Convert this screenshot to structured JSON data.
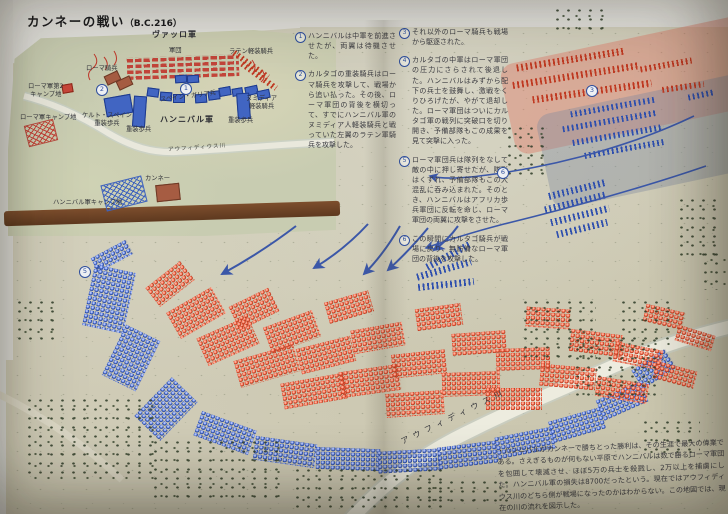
{
  "page": {
    "title": "カンネーの戦い",
    "title_suffix": "（B.C.216）"
  },
  "inset_map": {
    "labels": {
      "varro_army": "ヴァッロ軍",
      "legion": "軍団",
      "latin_cavalry": "ラテン軽装騎兵",
      "roman_cavalry": "ローマ騎兵",
      "roman_camp2": "ローマ軍第2\nキャンプ地",
      "roman_camp": "ローマ軍キャンプ地",
      "celt_spain_heavy": "ケルト・スペイン\n重装歩兵",
      "heavy_infantry_left": "重装歩兵",
      "spain_gaul": "スペイン・ガリア兵",
      "numidia_light_cavalry": "ヌミディア\n軽装騎兵",
      "heavy_infantry_right": "重装歩兵",
      "hannibal_army": "ハンニバル軍",
      "cannae": "カンネー",
      "hannibal_camp": "ハンニバル軍キャンプ地",
      "river": "アウフィディウス川"
    },
    "markers": [
      {
        "num": "2",
        "x": 96,
        "y": 84
      },
      {
        "num": "1",
        "x": 180,
        "y": 83
      }
    ],
    "units": [
      {
        "t": "bricks-red",
        "x": 127,
        "y": 56,
        "w": 112,
        "h": 22,
        "r": -2
      },
      {
        "t": "row-red",
        "x": 230,
        "y": 62,
        "w": 42,
        "h": 6,
        "r": 36
      },
      {
        "t": "row-red",
        "x": 238,
        "y": 73,
        "w": 42,
        "h": 6,
        "r": 36
      },
      {
        "t": "block-brown",
        "x": 105,
        "y": 73,
        "w": 13,
        "h": 8,
        "r": -25
      },
      {
        "t": "block-brown",
        "x": 117,
        "y": 78,
        "w": 13,
        "h": 8,
        "r": -25
      },
      {
        "t": "block-blue",
        "x": 175,
        "y": 75,
        "w": 10,
        "h": 6,
        "r": -4
      },
      {
        "t": "block-blue",
        "x": 187,
        "y": 75,
        "w": 10,
        "h": 6,
        "r": -4
      },
      {
        "t": "block-blue",
        "x": 147,
        "y": 88,
        "w": 10,
        "h": 7,
        "r": 8
      },
      {
        "t": "block-blue",
        "x": 160,
        "y": 92,
        "w": 10,
        "h": 7,
        "r": 4
      },
      {
        "t": "block-blue",
        "x": 173,
        "y": 94,
        "w": 10,
        "h": 7,
        "r": 0
      },
      {
        "t": "block-blue",
        "x": 195,
        "y": 94,
        "w": 10,
        "h": 7,
        "r": -4
      },
      {
        "t": "block-blue",
        "x": 208,
        "y": 91,
        "w": 10,
        "h": 7,
        "r": -8
      },
      {
        "t": "block-blue",
        "x": 219,
        "y": 87,
        "w": 10,
        "h": 7,
        "r": -10
      },
      {
        "t": "block-blue",
        "x": 232,
        "y": 88,
        "w": 9,
        "h": 6,
        "r": -10
      },
      {
        "t": "block-blue",
        "x": 245,
        "y": 86,
        "w": 11,
        "h": 7,
        "r": -12
      },
      {
        "t": "block-blue",
        "x": 257,
        "y": 90,
        "w": 11,
        "h": 7,
        "r": -12
      },
      {
        "t": "block-blue",
        "x": 105,
        "y": 96,
        "w": 25,
        "h": 17,
        "r": -10
      },
      {
        "t": "block-blue",
        "x": 133,
        "y": 96,
        "w": 11,
        "h": 29,
        "r": 4
      },
      {
        "t": "block-blue",
        "x": 237,
        "y": 93,
        "w": 11,
        "h": 24,
        "r": -4
      },
      {
        "t": "hatch-red",
        "x": 26,
        "y": 122,
        "w": 28,
        "h": 20,
        "r": -14
      },
      {
        "t": "block-red",
        "x": 62,
        "y": 84,
        "w": 9,
        "h": 7,
        "r": -10
      },
      {
        "t": "hatch-blue",
        "x": 103,
        "y": 180,
        "w": 40,
        "h": 25,
        "r": -14
      },
      {
        "t": "block-brown",
        "x": 156,
        "y": 184,
        "w": 22,
        "h": 15,
        "r": -6
      }
    ]
  },
  "annotations": {
    "column1": [
      {
        "num": "1",
        "text": "ハンニバルは中軍を前進させたが、両翼は待機させた。"
      },
      {
        "num": "2",
        "text": "カルタゴの重装騎兵はローマ騎兵を攻撃して、戦場から追い払った。その後、ローマ軍団の背後を横切って、すでにハンニバル軍のヌミディア人軽装騎兵と戦っていた左翼のラテン軍騎兵を攻撃した。"
      }
    ],
    "column2": [
      {
        "num": "3",
        "text": "それ以外のローマ騎兵も戦場から駆逐された。"
      },
      {
        "num": "4",
        "text": "カルタゴの中軍はローマ軍団の圧力にさらされて後退した。ハンニバルはみずから配下の兵士を鼓舞し、激戦をくりひろげたが、やがて退却した。ローマ軍団はついにカルタゴ軍の戦列に突破口を切り開き、予備部隊もこの成果を見て突撃に入った。"
      },
      {
        "num": "5",
        "text": "ローマ軍団兵は隊列をなして敵の中に押し寄せたが、隊形はくずれ、予備部隊もこの大混乱に呑み込まれた。そのとき、ハンニバルはアフリカ歩兵軍団に反転を命じ、ローマ軍団の両翼に攻撃をさせた。"
      },
      {
        "num": "6",
        "text": "この瞬間にカルタゴ騎兵が戦場に戻り、無防備なローマ軍団の背後を攻撃した。"
      }
    ]
  },
  "main_map": {
    "river_label": "アウフィディウス川",
    "caption": "・ハンニバルがカンネーで勝ちとった勝利は、その生涯で最大の偉業である。さえぎるものが何もない平原でハンニバルは数で勝るローマ軍団を包囲して壊滅させ、ほぼ5万の兵士を殺戮し、2万以上を捕虜にした。ハンニバル軍の損失は8700だったという。現在ではアウフィディウス川のどちら側が戦場になったのかはわからない。この地図では、現在の川の流れを図示した。",
    "markers": [
      {
        "num": "3",
        "x": 586,
        "y": 85
      },
      {
        "num": "5",
        "x": 79,
        "y": 266
      },
      {
        "num": "6",
        "x": 497,
        "y": 167
      }
    ],
    "units": [
      {
        "t": "zone-pink",
        "x": 505,
        "y": 38,
        "w": 262,
        "h": 92,
        "r": -12
      },
      {
        "t": "zone-gray",
        "x": 542,
        "y": 92,
        "w": 225,
        "h": 96,
        "r": -12
      },
      {
        "t": "row-red",
        "x": 516,
        "y": 56,
        "w": 110,
        "h": 7,
        "r": -9
      },
      {
        "t": "row-red",
        "x": 512,
        "y": 72,
        "w": 128,
        "h": 7,
        "r": -9
      },
      {
        "t": "row-red",
        "x": 532,
        "y": 88,
        "w": 120,
        "h": 7,
        "r": -8
      },
      {
        "t": "row-red",
        "x": 640,
        "y": 62,
        "w": 52,
        "h": 6,
        "r": -10
      },
      {
        "t": "row-red",
        "x": 662,
        "y": 84,
        "w": 42,
        "h": 6,
        "r": -8
      },
      {
        "t": "row-blue",
        "x": 570,
        "y": 104,
        "w": 86,
        "h": 6,
        "r": -10
      },
      {
        "t": "row-blue",
        "x": 562,
        "y": 118,
        "w": 96,
        "h": 6,
        "r": -10
      },
      {
        "t": "row-blue",
        "x": 572,
        "y": 132,
        "w": 92,
        "h": 6,
        "r": -10
      },
      {
        "t": "row-blue",
        "x": 584,
        "y": 146,
        "w": 80,
        "h": 6,
        "r": -10
      },
      {
        "t": "row-blue",
        "x": 688,
        "y": 92,
        "w": 26,
        "h": 6,
        "r": -12
      },
      {
        "t": "row-blue",
        "x": 548,
        "y": 186,
        "w": 58,
        "h": 7,
        "r": -14
      },
      {
        "t": "row-blue",
        "x": 544,
        "y": 199,
        "w": 62,
        "h": 7,
        "r": -14
      },
      {
        "t": "row-blue",
        "x": 550,
        "y": 212,
        "w": 60,
        "h": 7,
        "r": -14
      },
      {
        "t": "row-blue",
        "x": 556,
        "y": 225,
        "w": 52,
        "h": 7,
        "r": -14
      },
      {
        "t": "row-blue",
        "x": 424,
        "y": 252,
        "w": 50,
        "h": 7,
        "r": -28
      },
      {
        "t": "row-blue",
        "x": 416,
        "y": 266,
        "w": 56,
        "h": 7,
        "r": -16
      },
      {
        "t": "row-blue",
        "x": 418,
        "y": 281,
        "w": 56,
        "h": 7,
        "r": -6
      },
      {
        "t": "beads-blue",
        "x": 92,
        "y": 248,
        "w": 40,
        "h": 16,
        "r": -28
      },
      {
        "t": "beads-blue",
        "x": 88,
        "y": 268,
        "w": 42,
        "h": 62,
        "r": 12
      },
      {
        "t": "beads-blue",
        "x": 112,
        "y": 330,
        "w": 38,
        "h": 56,
        "r": 26
      },
      {
        "t": "beads-blue",
        "x": 148,
        "y": 382,
        "w": 36,
        "h": 54,
        "r": 44
      },
      {
        "t": "beads-blue",
        "x": 196,
        "y": 420,
        "w": 58,
        "h": 26,
        "r": 20
      },
      {
        "t": "beads-blue",
        "x": 254,
        "y": 440,
        "w": 62,
        "h": 24,
        "r": 8
      },
      {
        "t": "beads-blue",
        "x": 316,
        "y": 448,
        "w": 64,
        "h": 22,
        "r": 2
      },
      {
        "t": "beads-blue",
        "x": 378,
        "y": 450,
        "w": 62,
        "h": 22,
        "r": -3
      },
      {
        "t": "beads-blue",
        "x": 438,
        "y": 444,
        "w": 60,
        "h": 22,
        "r": -7
      },
      {
        "t": "beads-blue",
        "x": 496,
        "y": 432,
        "w": 58,
        "h": 22,
        "r": -11
      },
      {
        "t": "beads-blue",
        "x": 550,
        "y": 414,
        "w": 54,
        "h": 22,
        "r": -16
      },
      {
        "t": "beads-blue",
        "x": 598,
        "y": 390,
        "w": 48,
        "h": 22,
        "r": -24
      },
      {
        "t": "beads-blue",
        "x": 634,
        "y": 358,
        "w": 40,
        "h": 22,
        "r": -33
      },
      {
        "t": "beads-red",
        "x": 148,
        "y": 272,
        "w": 44,
        "h": 24,
        "r": -38
      },
      {
        "t": "beads-red",
        "x": 170,
        "y": 298,
        "w": 52,
        "h": 30,
        "r": -30
      },
      {
        "t": "beads-red",
        "x": 200,
        "y": 326,
        "w": 56,
        "h": 30,
        "r": -24
      },
      {
        "t": "beads-red",
        "x": 232,
        "y": 296,
        "w": 44,
        "h": 26,
        "r": -26
      },
      {
        "t": "beads-red",
        "x": 236,
        "y": 352,
        "w": 62,
        "h": 28,
        "r": -16
      },
      {
        "t": "beads-red",
        "x": 266,
        "y": 318,
        "w": 52,
        "h": 28,
        "r": -20
      },
      {
        "t": "beads-red",
        "x": 282,
        "y": 378,
        "w": 64,
        "h": 26,
        "r": -10
      },
      {
        "t": "beads-red",
        "x": 298,
        "y": 342,
        "w": 56,
        "h": 26,
        "r": -14
      },
      {
        "t": "beads-red",
        "x": 326,
        "y": 296,
        "w": 46,
        "h": 22,
        "r": -16
      },
      {
        "t": "beads-red",
        "x": 340,
        "y": 368,
        "w": 60,
        "h": 26,
        "r": -8
      },
      {
        "t": "beads-red",
        "x": 352,
        "y": 326,
        "w": 52,
        "h": 24,
        "r": -10
      },
      {
        "t": "beads-red",
        "x": 386,
        "y": 392,
        "w": 58,
        "h": 24,
        "r": -4
      },
      {
        "t": "beads-red",
        "x": 392,
        "y": 352,
        "w": 54,
        "h": 24,
        "r": -6
      },
      {
        "t": "beads-red",
        "x": 416,
        "y": 306,
        "w": 46,
        "h": 22,
        "r": -8
      },
      {
        "t": "beads-red",
        "x": 442,
        "y": 372,
        "w": 58,
        "h": 24,
        "r": -2
      },
      {
        "t": "beads-red",
        "x": 452,
        "y": 332,
        "w": 54,
        "h": 22,
        "r": -4
      },
      {
        "t": "beads-red",
        "x": 486,
        "y": 388,
        "w": 56,
        "h": 22,
        "r": 0
      },
      {
        "t": "beads-red",
        "x": 496,
        "y": 348,
        "w": 54,
        "h": 22,
        "r": -2
      },
      {
        "t": "beads-red",
        "x": 526,
        "y": 308,
        "w": 44,
        "h": 20,
        "r": 4
      },
      {
        "t": "beads-red",
        "x": 540,
        "y": 366,
        "w": 56,
        "h": 22,
        "r": 5
      },
      {
        "t": "beads-red",
        "x": 570,
        "y": 332,
        "w": 52,
        "h": 22,
        "r": 7
      },
      {
        "t": "beads-red",
        "x": 596,
        "y": 380,
        "w": 52,
        "h": 20,
        "r": 9
      },
      {
        "t": "beads-red",
        "x": 614,
        "y": 346,
        "w": 48,
        "h": 20,
        "r": 11
      },
      {
        "t": "beads-red",
        "x": 644,
        "y": 308,
        "w": 40,
        "h": 18,
        "r": 13
      },
      {
        "t": "beads-red",
        "x": 654,
        "y": 366,
        "w": 42,
        "h": 18,
        "r": 15
      },
      {
        "t": "beads-red",
        "x": 676,
        "y": 330,
        "w": 38,
        "h": 16,
        "r": 17
      }
    ],
    "tree_clusters": [
      {
        "x": 504,
        "y": 124,
        "w": 40,
        "h": 54
      },
      {
        "x": 552,
        "y": 6,
        "w": 58,
        "h": 26
      },
      {
        "x": 676,
        "y": 196,
        "w": 48,
        "h": 62
      },
      {
        "x": 520,
        "y": 298,
        "w": 76,
        "h": 66
      },
      {
        "x": 572,
        "y": 336,
        "w": 84,
        "h": 62
      },
      {
        "x": 618,
        "y": 298,
        "w": 58,
        "h": 48
      },
      {
        "x": 24,
        "y": 396,
        "w": 130,
        "h": 84
      },
      {
        "x": 150,
        "y": 438,
        "w": 130,
        "h": 62
      },
      {
        "x": 292,
        "y": 466,
        "w": 150,
        "h": 42
      },
      {
        "x": 424,
        "y": 478,
        "w": 86,
        "h": 30
      },
      {
        "x": 14,
        "y": 298,
        "w": 44,
        "h": 44
      },
      {
        "x": 640,
        "y": 418,
        "w": 60,
        "h": 40
      },
      {
        "x": 700,
        "y": 250,
        "w": 26,
        "h": 40
      }
    ]
  },
  "colors": {
    "terrain_inset": "#c8ccb1",
    "terrain_main": "#cfcbb6",
    "red_unit": "#e34b2e",
    "blue_unit": "#3f63bd",
    "road_brown": "#6e4326",
    "river": "#ebe9db",
    "pink_zone": "#e07664",
    "gray_zone": "#7d899e",
    "marker_blue": "#2f4f9e",
    "text": "#3a3a40"
  }
}
